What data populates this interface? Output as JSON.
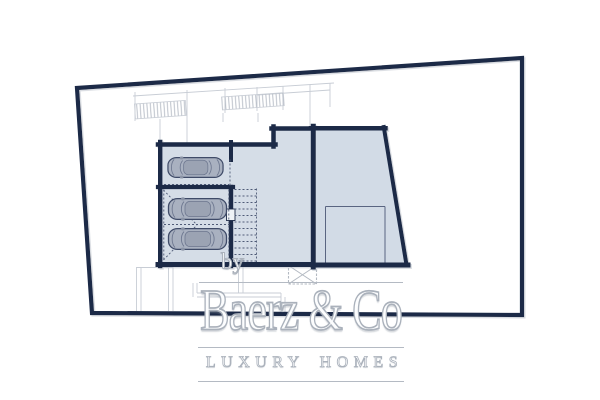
{
  "watermark": {
    "prefix": "by",
    "brand": "Baerz & Co",
    "tagline": "LUXURY HOMES"
  },
  "plan": {
    "cars_visible": 3,
    "stair_treads": 12,
    "rooms_visible": 4
  },
  "colors": {
    "wall_navy": "#1c2a47",
    "room_fill": "#d5dde7",
    "room_fill_right": "#d2dbe6",
    "car_body": "#a9b1c0",
    "car_cabin": "#9ba3b3",
    "car_outline": "#3f4b68",
    "site_line": "#c8cdd5",
    "hatch_tick": "#b4bac4",
    "dash_line": "#4f5b77",
    "grate_line": "#b3b9c2",
    "watermark_stroke": "#aab1bb",
    "watermark_fill": "#fcfdfe",
    "rule_gray": "#b4bac3"
  }
}
